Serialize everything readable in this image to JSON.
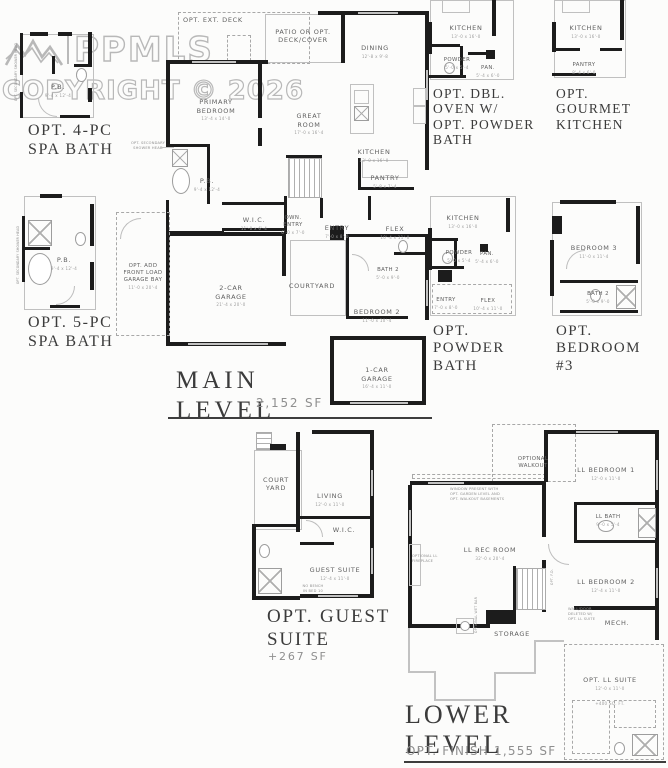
{
  "palette": {
    "wall": "#1c1c1c",
    "thin_line": "#c0c0c0",
    "label": "#606060",
    "title": "#3b3b3b",
    "watermark": "#adadad"
  },
  "watermark": {
    "brand": "PPMLS",
    "copyright": "COPYRIGHT © 2026"
  },
  "insets": {
    "spa4": {
      "title": "OPT. 4-PC\nSPA BATH",
      "note": "OPT. SECONDARY SHOWER HEAD",
      "rooms": {
        "pb": {
          "label": "P.B.",
          "dim": "9'-4 x 12'-4"
        }
      }
    },
    "spa5": {
      "title": "OPT. 5-PC\nSPA BATH",
      "note": "OPT. SECONDARY SHOWER HEAD",
      "rooms": {
        "pb": {
          "label": "P.B.",
          "dim": "9'-4 x 12'-4"
        }
      }
    },
    "dbl_oven": {
      "title": "OPT. DBL.\nOVEN W/\nOPT. POWDER\nBATH",
      "rooms": {
        "kitchen": {
          "label": "KITCHEN",
          "dim": "13'-0 x 16'-0"
        },
        "powder": {
          "label": "POWDER",
          "dim": "5'-0 x 5'-4"
        },
        "pan": {
          "label": "PAN.",
          "dim": "5'-4 x 6'-0"
        }
      }
    },
    "gourmet": {
      "title": "OPT.\nGOURMET\nKITCHEN",
      "rooms": {
        "kitchen": {
          "label": "KITCHEN",
          "dim": "13'-0 x 16'-0"
        },
        "pantry": {
          "label": "PANTRY",
          "dim": "8'-4 x 6'-0"
        }
      }
    },
    "powder_bath": {
      "title": "OPT.\nPOWDER\nBATH",
      "rooms": {
        "kitchen": {
          "label": "KITCHEN",
          "dim": "13'-0 x 16'-0"
        },
        "powder": {
          "label": "POWDER",
          "dim": "5'-0 x 5'-4"
        },
        "pan": {
          "label": "PAN.",
          "dim": "5'-4 x 6'-0"
        },
        "entry": {
          "label": "ENTRY",
          "dim": "7'-0 x 8'-0"
        },
        "flex": {
          "label": "FLEX",
          "dim": "10'-4 x 11'-0"
        }
      }
    },
    "bedroom3": {
      "title": "OPT.\nBEDROOM\n#3",
      "rooms": {
        "bedroom3": {
          "label": "BEDROOM 3",
          "dim": "11'-0 x 11'-4"
        },
        "bath2": {
          "label": "BATH 2",
          "dim": "5'-0 x 9'-0"
        }
      }
    },
    "guest": {
      "title": "OPT. GUEST\nSUITE",
      "sf": "+267 SF",
      "note": "NO BENCH\nIN BED 10",
      "rooms": {
        "courtyard": {
          "label": "COURT\nYARD"
        },
        "living": {
          "label": "LIVING",
          "dim": "12'-0 x 11'-0"
        },
        "wic": {
          "label": "W.I.C."
        },
        "guest_suite": {
          "label": "GUEST SUITE",
          "dim": "12'-4 x 11'-0"
        }
      }
    }
  },
  "main_level": {
    "title": "MAIN\nLEVEL",
    "sf": "2,152 SF",
    "notes": {
      "shower": "OPT. SECONDARY\nSHOWER HEAD"
    },
    "rooms": {
      "ext_deck": {
        "label": "OPT. EXT. DECK"
      },
      "patio": {
        "label": "PATIO OR OPT.\nDECK/COVER"
      },
      "dining": {
        "label": "DINING",
        "dim": "12'-8 x 9'-8"
      },
      "primary": {
        "label": "PRIMARY\nBEDROOM",
        "dim": "13'-4 x 14'-0"
      },
      "great": {
        "label": "GREAT\nROOM",
        "dim": "17'-0 x 16'-4"
      },
      "kitchen": {
        "label": "KITCHEN",
        "dim": "13'-0 x 16'-0"
      },
      "pantry": {
        "label": "PANTRY",
        "dim": "5'-8 x 7'-4"
      },
      "pb": {
        "label": "P.B.",
        "dim": "9'-4 x 12'-4"
      },
      "wic": {
        "label": "W.I.C.",
        "dim": "11'-0 x 6'-4"
      },
      "own_entry": {
        "label": "OWN.\nENTRY",
        "dim": "6'-0 x 7'-0"
      },
      "entry": {
        "label": "ENTRY",
        "dim": "7'-0 x 8'-0"
      },
      "flex": {
        "label": "FLEX",
        "dim": "10'-4 x 11'-0"
      },
      "bath2": {
        "label": "BATH 2",
        "dim": "5'-0 x 9'-0"
      },
      "bedroom2": {
        "label": "BEDROOM 2",
        "dim": "11'-0 x 10'-4"
      },
      "courtyard": {
        "label": "COURTYARD"
      },
      "garage2": {
        "label": "2-CAR\nGARAGE",
        "dim": "21'-4 x 20'-0"
      },
      "garage_bay": {
        "label": "OPT. ADD\nFRONT LOAD\nGARAGE BAY",
        "dim": "11'-0 x 20'-4"
      },
      "garage1": {
        "label": "1-CAR\nGARAGE",
        "dim": "16'-4 x 11'-0"
      }
    }
  },
  "lower_level": {
    "title": "LOWER\nLEVEL",
    "sf": "OPT. FINISH 1,555 SF",
    "notes": {
      "window": "WINDOW PRESENT WITH\nOPT. GARDEN LEVEL AND\nOPT. WALKOUT BASEMENTS",
      "fireplace": "OPTIONAL LL\nFIREPLACE",
      "wetbar": "OPTIONAL WET BAR",
      "deleted": "WALL/DOOR\nDELETED W/\nOPT. LL SUITE",
      "stair_door": "OPT. F.D."
    },
    "rooms": {
      "walkout": {
        "label": "OPTIONAL\nWALKOUT"
      },
      "ll_bed1": {
        "label": "LL BEDROOM 1",
        "dim": "12'-0 x 11'-0"
      },
      "ll_bath": {
        "label": "LL BATH",
        "dim": "9'-0 x 5'-4"
      },
      "ll_rec": {
        "label": "LL REC ROOM",
        "dim": "32'-0 x 20'-4"
      },
      "ll_bed2": {
        "label": "LL BEDROOM 2",
        "dim": "12'-4 x 11'-0"
      },
      "mech": {
        "label": "MECH."
      },
      "storage": {
        "label": "STORAGE"
      },
      "ll_suite": {
        "label": "OPT. LL SUITE",
        "dim": "12'-0 x 11'-0",
        "sf": "+400 SQ. FT."
      }
    }
  }
}
